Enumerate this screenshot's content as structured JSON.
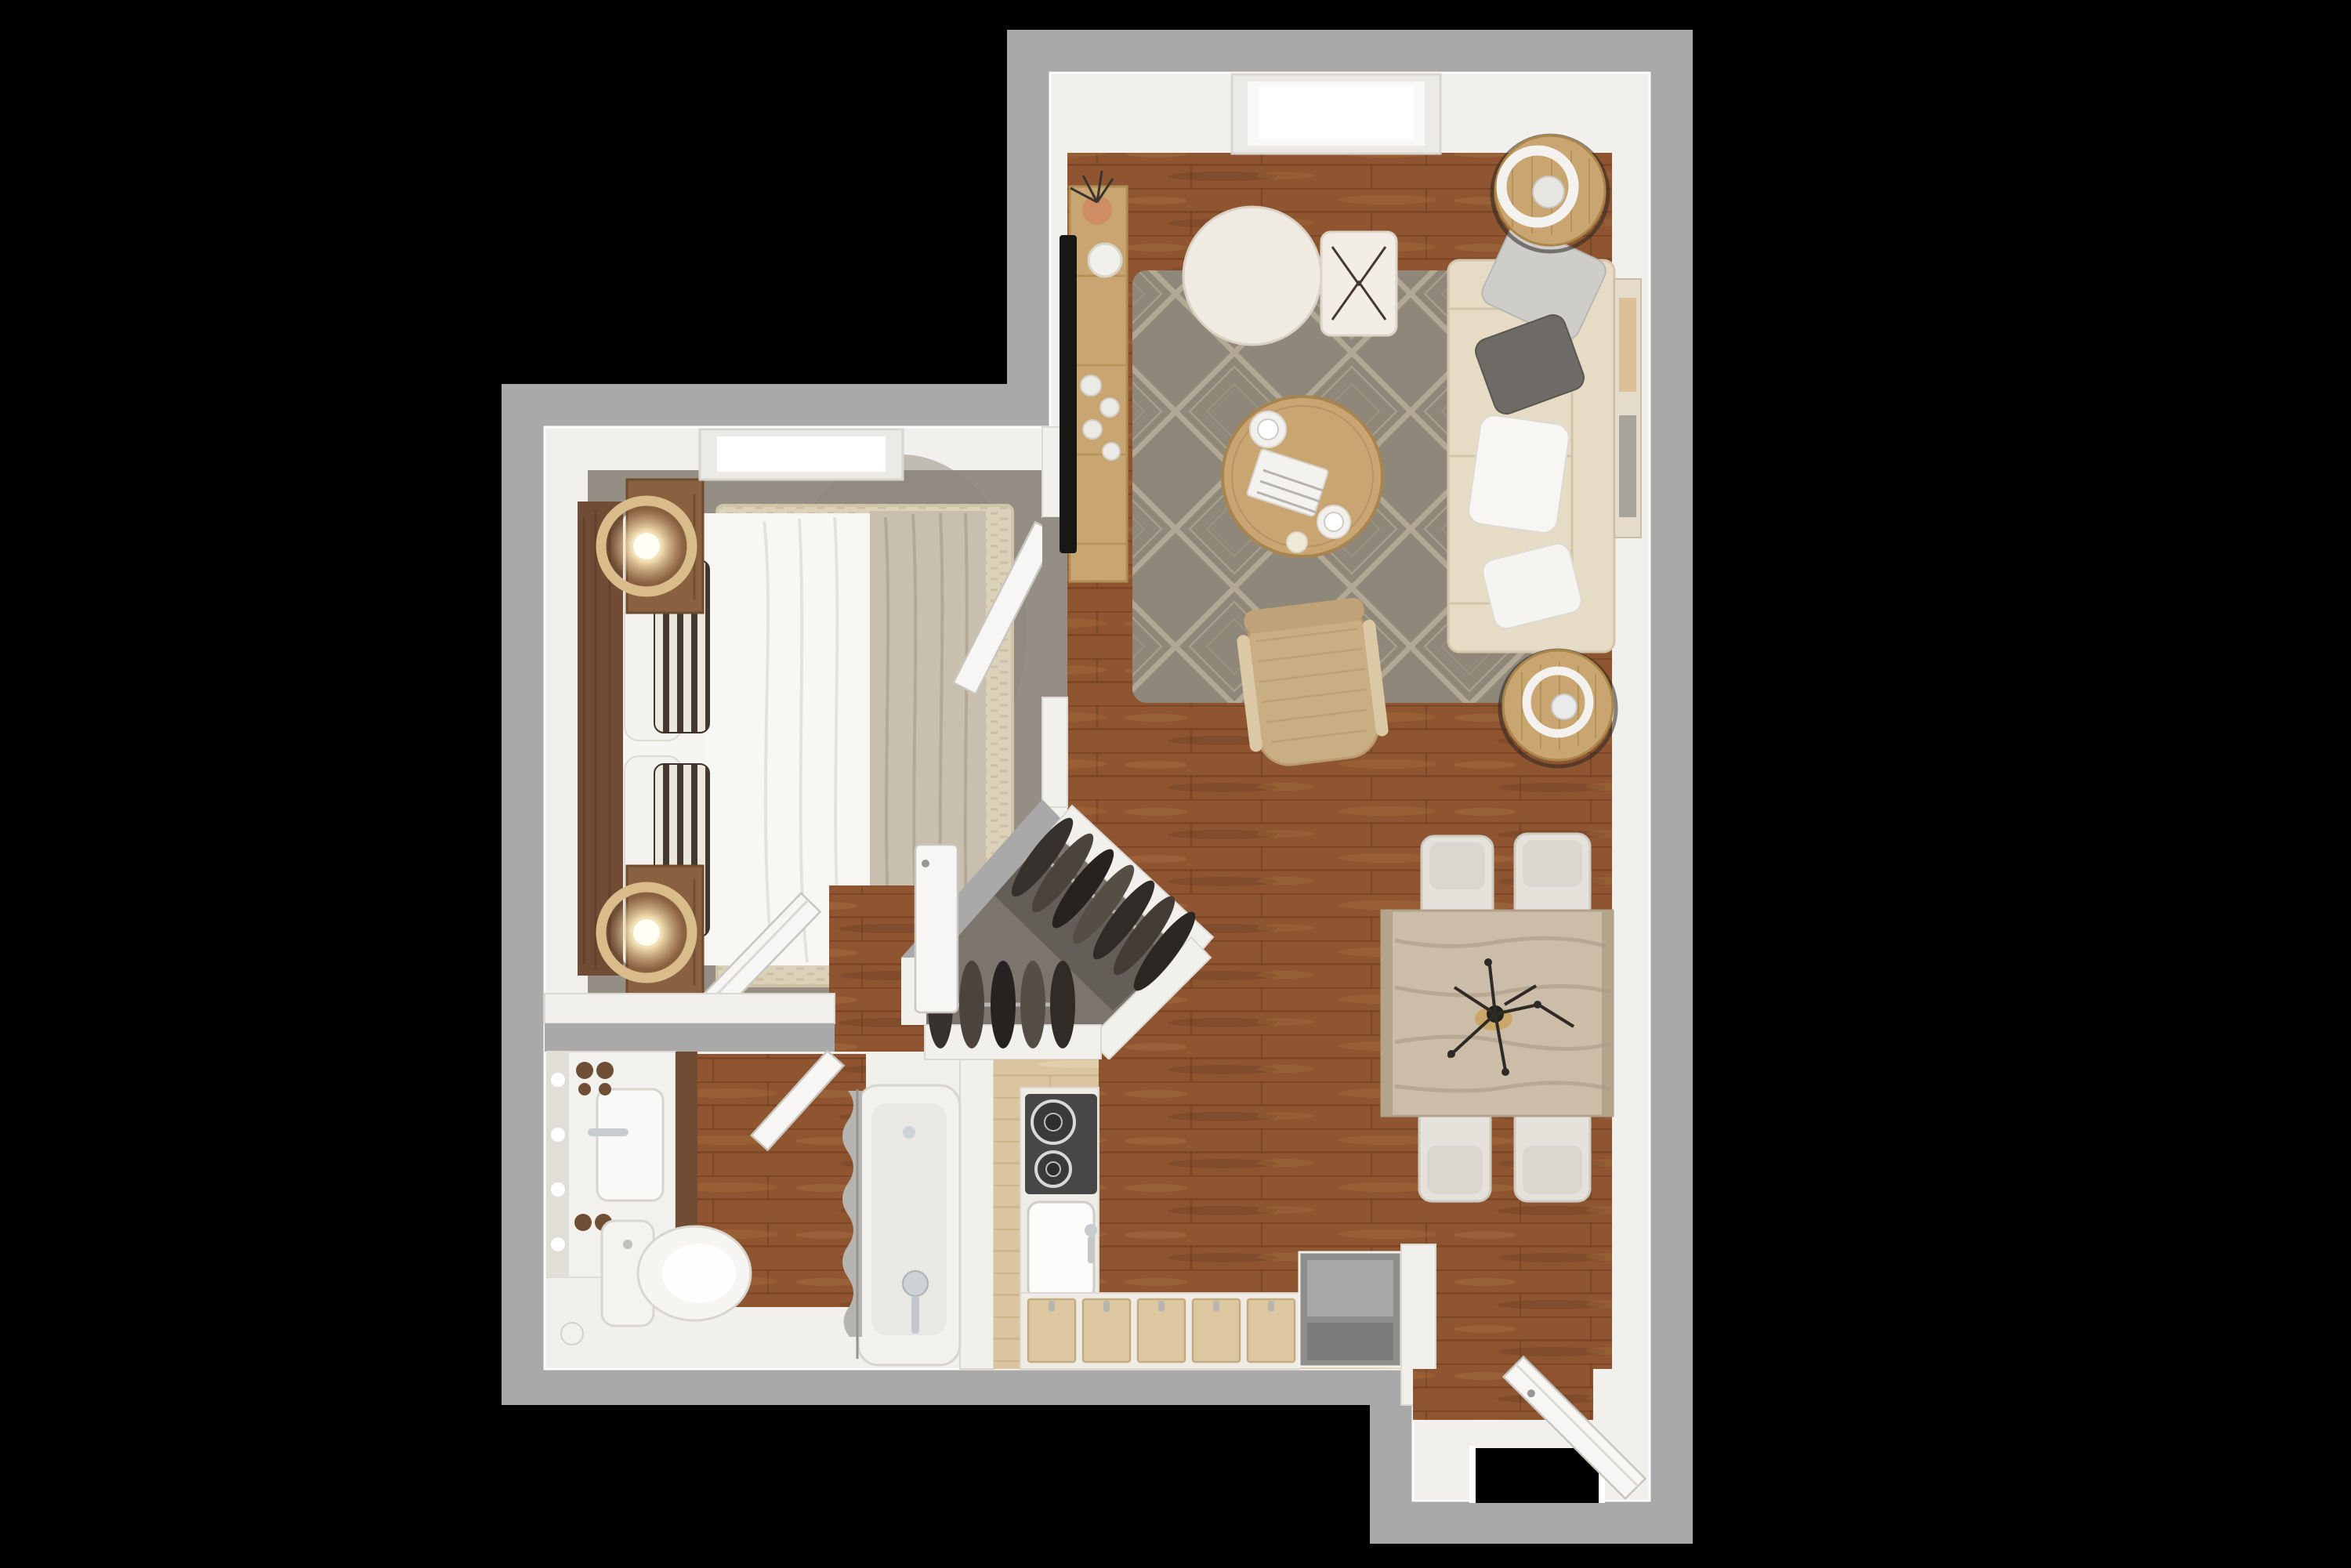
{
  "meta": {
    "title": "Top-down 3D rendered apartment floor plan",
    "type": "floor-plan-render",
    "background": "#000000"
  },
  "palette": {
    "wall_ext": "#a9a9a9",
    "wall_int": "#f2f0ec",
    "floor_wood": "#8f5530",
    "floor_wood_pale": "#dbc5a0",
    "carpet": "#958e84",
    "closet_floor": "#7b756d",
    "closet_floor_dark": "#5f5a53",
    "rug": "#8f8779",
    "rug_bed": "#dcd2ba",
    "sofa": "#e6dcc6",
    "wood_mid": "#c9a671",
    "table_pale": "#cbbda8",
    "chair_white": "#e5e2db",
    "chair_tan": "#c9ad83",
    "headboard": "#6f4c33",
    "nightstand": "#8a6140",
    "blanket": "#c9bfae",
    "white_soft": "#f6f5f2",
    "stove": "#474747",
    "appliance": "#8e8e8c",
    "curtain": "#b7b5b2",
    "door": "#f7f6f4",
    "gold": "#d9bc8a",
    "clothes": "#36312c",
    "tile": "#ebe9e5",
    "art": "#e4dbcb",
    "glass_black": "#000000"
  },
  "rooms": {
    "living_room": {
      "floor": "hardwood",
      "skylights": 1,
      "items": [
        "media-console-with-tv",
        "area-rug-diamond",
        "round-pouf",
        "square-pouf",
        "round-coffee-table",
        "sofa-with-pillows",
        "side-table-lamp-top",
        "side-table-lamp-bottom",
        "accent-chair",
        "wall-art"
      ]
    },
    "dining_area": {
      "floor": "hardwood",
      "items": [
        "dining-table",
        "dining-chairs-x4",
        "branch-centerpiece"
      ]
    },
    "kitchen": {
      "floor": "pale-wood",
      "items": [
        "cooktop-2-burners",
        "kitchen-sink",
        "lower-cabinets-x5",
        "gray-appliance",
        "l-shaped-counter"
      ]
    },
    "bedroom": {
      "floor": "carpet",
      "skylights": 1,
      "items": [
        "bed-queen",
        "headboard",
        "pillows-striped-x2",
        "nightstands-x2",
        "ring-lamps-x2",
        "cream-area-rug",
        "door-open"
      ]
    },
    "closet": {
      "floor": "concrete",
      "items": [
        "clothes-rack-diagonal-7",
        "clothes-rack-horizontal-5",
        "white-panel-door"
      ]
    },
    "bathroom": {
      "floor": "wood-and-tile",
      "items": [
        "vanity-with-sink",
        "linen-cabinet",
        "toilet",
        "bathtub",
        "shower-curtain",
        "door-open"
      ]
    },
    "entry": {
      "floor": "tile-and-wood",
      "items": [
        "front-door-open",
        "door-opening"
      ]
    }
  },
  "counts": {
    "doors_open": 4,
    "skylights": 2,
    "dining_chairs": 4,
    "hanging_clothes": 12,
    "sofa_pillows": 4
  }
}
